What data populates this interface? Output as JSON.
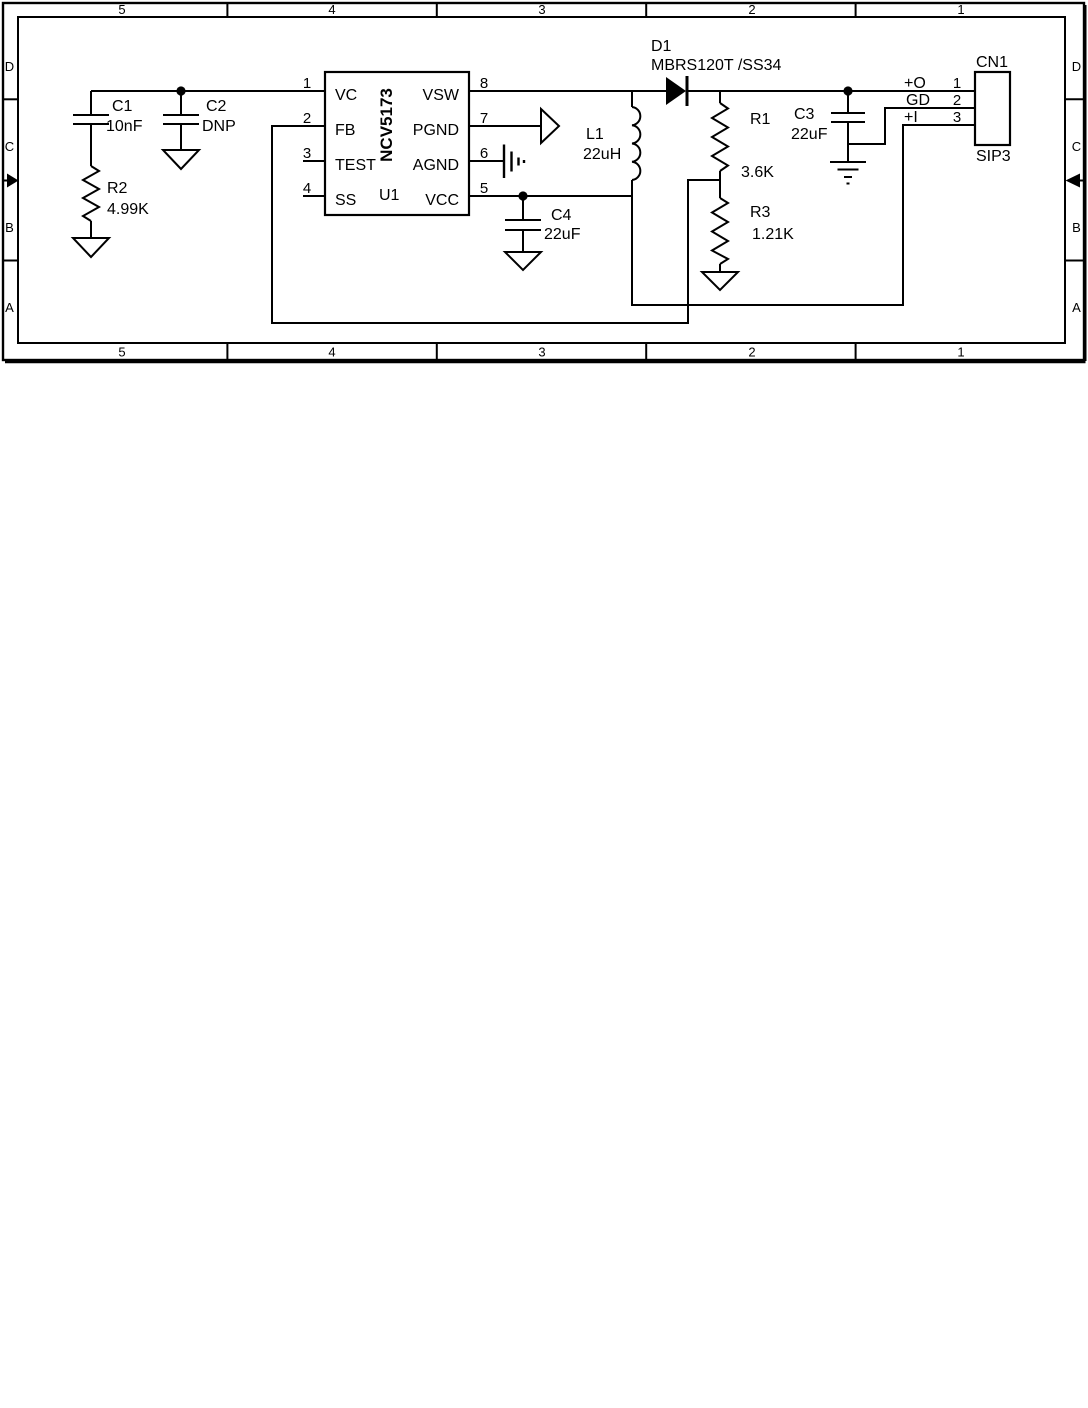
{
  "colors": {
    "ink": "#000000",
    "paper": "#ffffff"
  },
  "border": {
    "columns": [
      "5",
      "4",
      "3",
      "2",
      "1"
    ],
    "rows": [
      "D",
      "C",
      "B",
      "A"
    ]
  },
  "ic": {
    "refdes": "U1",
    "part": "NCV5173",
    "pins_left": [
      {
        "num": "1",
        "name": "VC"
      },
      {
        "num": "2",
        "name": "FB"
      },
      {
        "num": "3",
        "name": "TEST"
      },
      {
        "num": "4",
        "name": "SS"
      }
    ],
    "pins_right": [
      {
        "num": "8",
        "name": "VSW"
      },
      {
        "num": "7",
        "name": "PGND"
      },
      {
        "num": "6",
        "name": "AGND"
      },
      {
        "num": "5",
        "name": "VCC"
      }
    ]
  },
  "parts": {
    "c1": {
      "ref": "C1",
      "val": "10nF"
    },
    "c2": {
      "ref": "C2",
      "val": "DNP"
    },
    "r2": {
      "ref": "R2",
      "val": "4.99K"
    },
    "d1": {
      "ref": "D1",
      "val": "MBRS120T /SS34"
    },
    "l1": {
      "ref": "L1",
      "val": "22uH"
    },
    "r1": {
      "ref": "R1",
      "val": "3.6K"
    },
    "r3": {
      "ref": "R3",
      "val": "1.21K"
    },
    "c3": {
      "ref": "C3",
      "val": "22uF"
    },
    "c4": {
      "ref": "C4",
      "val": "22uF"
    }
  },
  "connector": {
    "ref": "CN1",
    "val": "SIP3",
    "pins": [
      {
        "num": "1",
        "name": "+O"
      },
      {
        "num": "2",
        "name": "GD"
      },
      {
        "num": "3",
        "name": "+I"
      }
    ]
  }
}
